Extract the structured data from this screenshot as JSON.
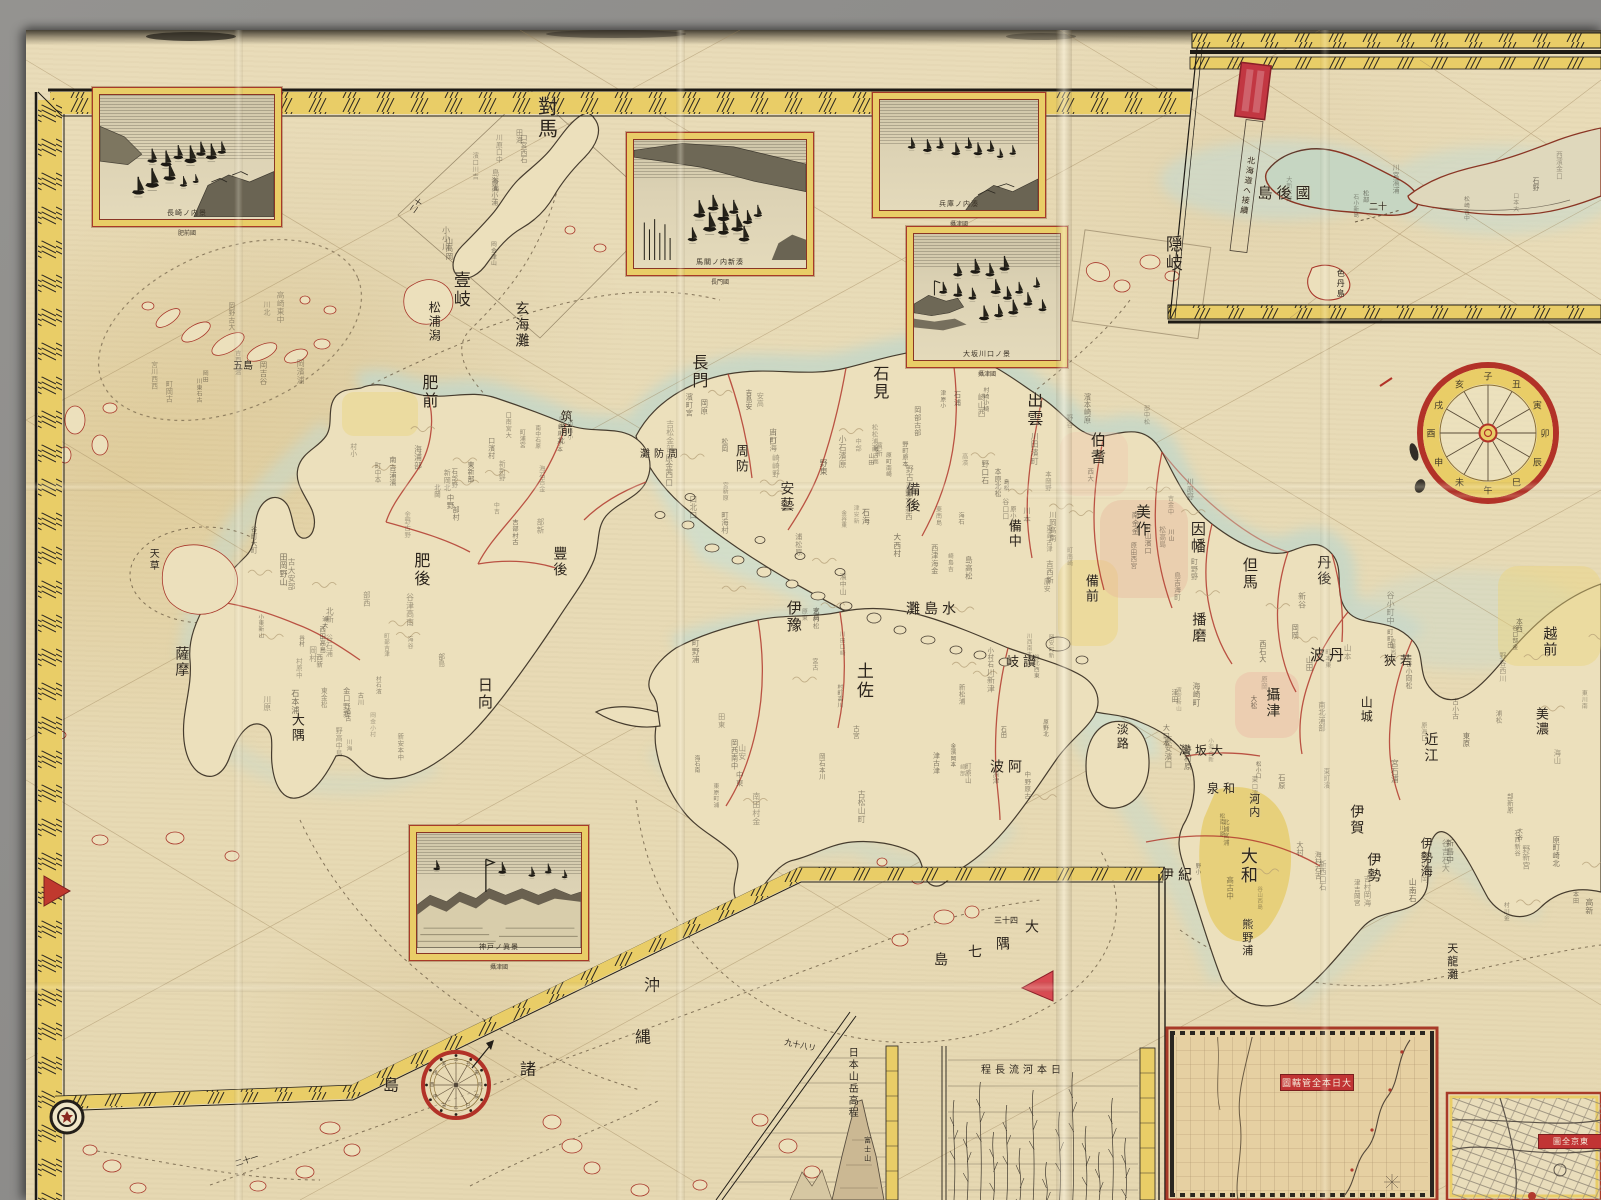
{
  "photo": {
    "backdrop_color": "#8d8c8a"
  },
  "sheet": {
    "paper_color": "#e8dbb6",
    "sea_tint": "#ccdbca",
    "border_yellow": "#e9cd67",
    "border_red": "#a83a28",
    "boundary_red": "#b23a2e",
    "seal_red": "#c23742",
    "ink_color": "#2b241c"
  },
  "insets": {
    "harbor_views": [
      {
        "id": "nagasaki",
        "caption": "長崎ノ内景",
        "subcaption": "肥前國"
      },
      {
        "id": "bakan",
        "caption": "馬關ノ内新湊",
        "subcaption": "長門國"
      },
      {
        "id": "hyogo",
        "caption": "兵庫ノ内湊",
        "subcaption": "攝津國"
      },
      {
        "id": "osaka",
        "caption": "大坂川口ノ景",
        "subcaption": "攝津國"
      },
      {
        "id": "kobe",
        "caption": "神戸ノ眞景",
        "subcaption": "攝津國"
      }
    ],
    "grid_map": {
      "title": "大日本全管轄圖"
    },
    "tokyo_map": {
      "title": "東京全圖"
    }
  },
  "compass": {
    "zodiac": "子丑寅卯辰巳午未申酉戌亥"
  },
  "texture": {
    "glyphs": "山川村田中大小島浦口町野原崎宮津本松石金吉岡谷部濱海西東南北新古高安"
  },
  "map_labels": [
    {
      "name": "tsushima",
      "t": "對馬",
      "x": 546,
      "y": 118,
      "s": 20,
      "o": "v"
    },
    {
      "name": "iki",
      "t": "壹岐",
      "x": 459,
      "y": 290,
      "s": 17,
      "o": "v"
    },
    {
      "name": "oki",
      "t": "隠岐",
      "x": 1171,
      "y": 254,
      "s": 17,
      "o": "v"
    },
    {
      "name": "matsuura-gata",
      "t": "松浦潟",
      "x": 434,
      "y": 322,
      "s": 12,
      "o": "v"
    },
    {
      "name": "genkai-nada",
      "t": "玄海灘",
      "x": 521,
      "y": 325,
      "s": 14,
      "o": "v"
    },
    {
      "name": "hizen",
      "t": "肥前",
      "x": 428,
      "y": 392,
      "s": 16,
      "o": "v"
    },
    {
      "name": "goto",
      "t": "五島",
      "x": 243,
      "y": 367,
      "s": 10,
      "o": "h"
    },
    {
      "name": "chikuzen",
      "t": "筑前",
      "x": 566,
      "y": 424,
      "s": 12,
      "o": "v"
    },
    {
      "name": "higo",
      "t": "肥後",
      "x": 420,
      "y": 570,
      "s": 16,
      "o": "v"
    },
    {
      "name": "bungo",
      "t": "豐後",
      "x": 559,
      "y": 562,
      "s": 14,
      "o": "v"
    },
    {
      "name": "amakusa",
      "t": "天草",
      "x": 152,
      "y": 560,
      "s": 10,
      "o": "v"
    },
    {
      "name": "hyuga",
      "t": "日向",
      "x": 484,
      "y": 694,
      "s": 15,
      "o": "v"
    },
    {
      "name": "satsuma",
      "t": "薩摩",
      "x": 181,
      "y": 662,
      "s": 14,
      "o": "v"
    },
    {
      "name": "osumi",
      "t": "大隅",
      "x": 296,
      "y": 728,
      "s": 13,
      "o": "v"
    },
    {
      "name": "nagato",
      "t": "長門",
      "x": 698,
      "y": 372,
      "s": 16,
      "o": "v"
    },
    {
      "name": "suo",
      "t": "周防",
      "x": 740,
      "y": 459,
      "s": 13,
      "o": "v"
    },
    {
      "name": "suo-nada",
      "t": "周防灘",
      "x": 661,
      "y": 455,
      "s": 10,
      "o": "h-rtl"
    },
    {
      "name": "iwami",
      "t": "石見",
      "x": 879,
      "y": 383,
      "s": 16,
      "o": "v"
    },
    {
      "name": "aki",
      "t": "安藝",
      "x": 786,
      "y": 497,
      "s": 14,
      "o": "v"
    },
    {
      "name": "bingo",
      "t": "備後",
      "x": 912,
      "y": 498,
      "s": 14,
      "o": "v"
    },
    {
      "name": "izumo",
      "t": "出雲",
      "x": 1033,
      "y": 410,
      "s": 16,
      "o": "v"
    },
    {
      "name": "hoki",
      "t": "伯耆",
      "x": 1097,
      "y": 449,
      "s": 15,
      "o": "v"
    },
    {
      "name": "bitchu",
      "t": "備中",
      "x": 1013,
      "y": 534,
      "s": 13,
      "o": "v"
    },
    {
      "name": "mimasaka",
      "t": "美作",
      "x": 1142,
      "y": 521,
      "s": 15,
      "o": "v"
    },
    {
      "name": "inaba",
      "t": "因幡",
      "x": 1197,
      "y": 538,
      "s": 15,
      "o": "v"
    },
    {
      "name": "tajima",
      "t": "但馬",
      "x": 1249,
      "y": 574,
      "s": 15,
      "o": "v"
    },
    {
      "name": "tango",
      "t": "丹後",
      "x": 1323,
      "y": 571,
      "s": 14,
      "o": "v"
    },
    {
      "name": "bizen",
      "t": "備前",
      "x": 1090,
      "y": 589,
      "s": 13,
      "o": "v"
    },
    {
      "name": "harima",
      "t": "播磨",
      "x": 1198,
      "y": 628,
      "s": 14,
      "o": "v"
    },
    {
      "name": "tanba",
      "t": "丹波",
      "x": 1329,
      "y": 656,
      "s": 15,
      "o": "h-rtl"
    },
    {
      "name": "wakasa",
      "t": "若狹",
      "x": 1400,
      "y": 661,
      "s": 12,
      "o": "h-rtl"
    },
    {
      "name": "settsu",
      "t": "攝津",
      "x": 1272,
      "y": 703,
      "s": 14,
      "o": "v"
    },
    {
      "name": "yamashiro",
      "t": "山城",
      "x": 1366,
      "y": 710,
      "s": 12,
      "o": "v"
    },
    {
      "name": "omi",
      "t": "近江",
      "x": 1430,
      "y": 748,
      "s": 14,
      "o": "v"
    },
    {
      "name": "mino",
      "t": "美濃",
      "x": 1540,
      "y": 722,
      "s": 13,
      "o": "v"
    },
    {
      "name": "echizen",
      "t": "越前",
      "x": 1549,
      "y": 642,
      "s": 14,
      "o": "v"
    },
    {
      "name": "osaka-bay",
      "t": "大坂灣",
      "x": 1203,
      "y": 751,
      "s": 12,
      "o": "h-rtl"
    },
    {
      "name": "awaji",
      "t": "淡路",
      "x": 1122,
      "y": 737,
      "s": 12,
      "o": "v"
    },
    {
      "name": "izumi",
      "t": "和泉",
      "x": 1223,
      "y": 789,
      "s": 12,
      "o": "h-rtl"
    },
    {
      "name": "kawachi",
      "t": "河内",
      "x": 1254,
      "y": 806,
      "s": 11,
      "o": "v"
    },
    {
      "name": "yamato",
      "t": "大和",
      "x": 1246,
      "y": 866,
      "s": 17,
      "o": "v"
    },
    {
      "name": "iga",
      "t": "伊賀",
      "x": 1356,
      "y": 820,
      "s": 14,
      "o": "v"
    },
    {
      "name": "ise",
      "t": "伊勢",
      "x": 1373,
      "y": 868,
      "s": 14,
      "o": "v"
    },
    {
      "name": "ise-sea",
      "t": "伊勢海",
      "x": 1426,
      "y": 858,
      "s": 12,
      "o": "v"
    },
    {
      "name": "kii",
      "t": "紀伊",
      "x": 1178,
      "y": 876,
      "s": 14,
      "o": "h-rtl"
    },
    {
      "name": "kumano-ura",
      "t": "熊野浦",
      "x": 1247,
      "y": 938,
      "s": 11,
      "o": "v"
    },
    {
      "name": "tenryu-nada",
      "t": "天龍灘",
      "x": 1452,
      "y": 962,
      "s": 11,
      "o": "v"
    },
    {
      "name": "iyo",
      "t": "伊豫",
      "x": 793,
      "y": 617,
      "s": 15,
      "o": "v"
    },
    {
      "name": "tosa",
      "t": "土佐",
      "x": 862,
      "y": 681,
      "s": 17,
      "o": "v"
    },
    {
      "name": "mishima-nada",
      "t": "水島灘",
      "x": 933,
      "y": 610,
      "s": 14,
      "o": "h-rtl"
    },
    {
      "name": "sanuki",
      "t": "讃岐",
      "x": 1023,
      "y": 663,
      "s": 13,
      "o": "h-rtl"
    },
    {
      "name": "awa",
      "t": "阿波",
      "x": 1008,
      "y": 768,
      "s": 14,
      "o": "h-rtl"
    },
    {
      "name": "okinawa-char-1",
      "t": "沖",
      "x": 652,
      "y": 986,
      "s": 16,
      "o": "h"
    },
    {
      "name": "okinawa-char-2",
      "t": "縄",
      "x": 643,
      "y": 1038,
      "s": 16,
      "o": "h"
    },
    {
      "name": "okinawa-char-3",
      "t": "諸",
      "x": 528,
      "y": 1070,
      "s": 16,
      "o": "h"
    },
    {
      "name": "okinawa-char-4",
      "t": "島",
      "x": 391,
      "y": 1086,
      "s": 16,
      "o": "h"
    },
    {
      "name": "osumi-shichito-1",
      "t": "大",
      "x": 1032,
      "y": 928,
      "s": 14,
      "o": "h"
    },
    {
      "name": "osumi-shichito-2",
      "t": "隅",
      "x": 1003,
      "y": 945,
      "s": 14,
      "o": "h"
    },
    {
      "name": "osumi-shichito-3",
      "t": "七",
      "x": 975,
      "y": 953,
      "s": 14,
      "o": "h"
    },
    {
      "name": "osumi-shichito-4",
      "t": "島",
      "x": 941,
      "y": 961,
      "s": 14,
      "o": "h"
    },
    {
      "name": "kunashiri",
      "t": "國後島",
      "x": 1286,
      "y": 194,
      "s": 15,
      "o": "h-rtl"
    },
    {
      "name": "shikotan",
      "t": "色丹島",
      "x": 1340,
      "y": 284,
      "s": 8,
      "o": "v"
    },
    {
      "name": "hokkaido-note",
      "t": "北海道ヘ接續",
      "x": 1247,
      "y": 186,
      "s": 8,
      "o": "v",
      "r": 8
    },
    {
      "name": "route-dist-1",
      "t": "二十",
      "x": 1378,
      "y": 208,
      "s": 9,
      "o": "h"
    },
    {
      "name": "route-dist-2",
      "t": "三十四",
      "x": 1006,
      "y": 921,
      "s": 8,
      "o": "h"
    },
    {
      "name": "route-dist-3",
      "t": "九十八リ",
      "x": 800,
      "y": 1046,
      "s": 8,
      "o": "h",
      "r": 12
    },
    {
      "name": "route-dist-4",
      "t": "二十一",
      "x": 247,
      "y": 1161,
      "s": 8,
      "o": "h",
      "r": -18
    },
    {
      "name": "route-dist-5",
      "t": "二十",
      "x": 417,
      "y": 206,
      "s": 8,
      "o": "h",
      "r": -55
    },
    {
      "name": "fuji",
      "t": "富士山",
      "x": 867,
      "y": 1150,
      "s": 7,
      "o": "v"
    },
    {
      "name": "mountains-chart-title",
      "t": "日本山岳高程",
      "x": 851,
      "y": 1083,
      "s": 10,
      "o": "v"
    },
    {
      "name": "rivers-chart-title",
      "t": "日本河流長程",
      "x": 1023,
      "y": 1071,
      "s": 10,
      "o": "h-rtl"
    }
  ]
}
